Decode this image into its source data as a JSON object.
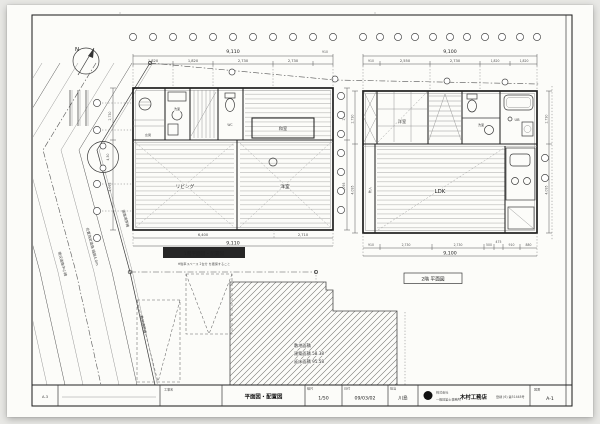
{
  "north": {
    "label": "N"
  },
  "site": {
    "plan_label": "1階平面図・配置図",
    "plan_note": "※駐車スペース 2台分 を確保すること",
    "tree_dim": "4,50",
    "road_labels": [
      "道路境界線",
      "位置指定道路 幅員4.0m",
      "現況道路中心線",
      "敷地境界線"
    ],
    "existing": {
      "line1": "敷地面積",
      "line2": "建築面積  58.38",
      "line3": "延床面積  95.58"
    }
  },
  "plan1f": {
    "dims_top": {
      "overall": "9,110",
      "extra": "910",
      "segments": [
        "1,820",
        "1,820",
        "2,730",
        "2,730"
      ]
    },
    "dims_bottom": {
      "overall": "9,110",
      "segments": [
        "6,400",
        "2,710"
      ]
    },
    "dims_left": [
      "2,730",
      "4,095"
    ],
    "dims_right": [
      "2,730",
      "4,095"
    ],
    "rooms": {
      "genkan": "玄関",
      "wash": "洗面",
      "wc": "WC",
      "washitsu": "和室",
      "living": "リビング",
      "bedroom": "洋室"
    }
  },
  "plan2f": {
    "label": "2階 平面図",
    "dims_top": {
      "overall": "9,100",
      "segments": [
        "910",
        "2,550",
        "2,730",
        "1,820",
        "1,820"
      ]
    },
    "dims_bottom": {
      "overall": "9,100",
      "segments": [
        "910",
        "2,730",
        "2,730",
        "500",
        "475",
        "910",
        "880"
      ]
    },
    "dims_left": [
      "2,730",
      "4,095"
    ],
    "dims_right": [
      "2,730",
      "4,095"
    ],
    "rooms": {
      "bedroom": "洋室",
      "wash": "洗面",
      "bath": "UB",
      "ldk": "LDK",
      "closet": "物入"
    }
  },
  "titleblock": {
    "sheet_code": "A-3",
    "name_label": "工事名",
    "title": "平面図・配置図",
    "scale_label": "縮尺",
    "scale": "1/50",
    "date_label": "日付",
    "date": "09/03/02",
    "staff_label": "担当",
    "staff": "川島",
    "company_prefix": "株式会社",
    "company": "木村工務店",
    "company_sub": "一級建築士事務所",
    "company_reg": "登録 (6) 第51448号",
    "sheet_label": "図番",
    "sheet_no": "A-1"
  }
}
